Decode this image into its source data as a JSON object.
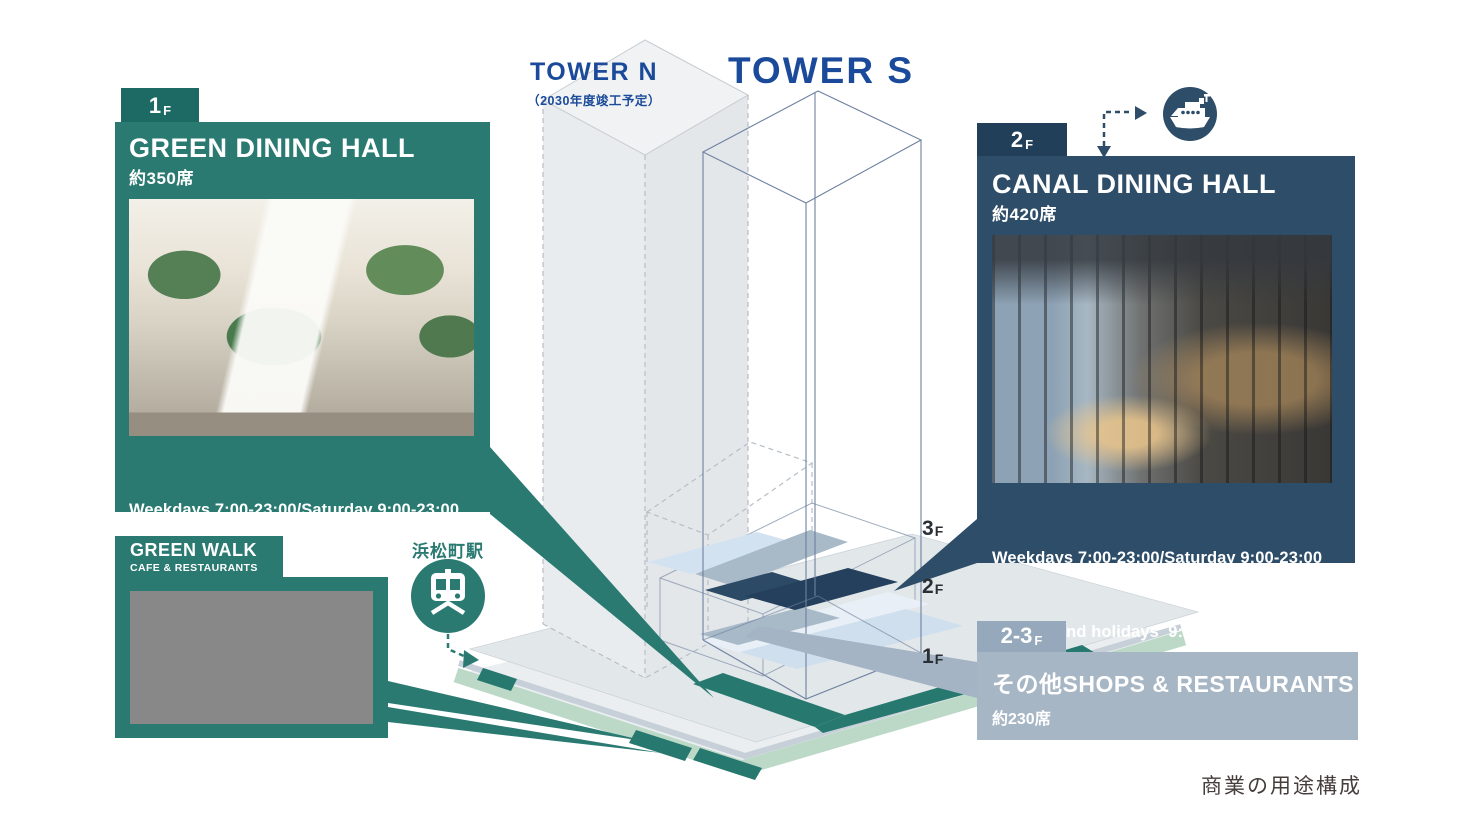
{
  "page": {
    "caption": "商業の用途構成"
  },
  "towers": {
    "tower_n": {
      "label": "TOWER N",
      "sub": "（2030年度竣工予定）"
    },
    "tower_s": {
      "label": "TOWER S"
    }
  },
  "floor_markers": [
    {
      "num": "3",
      "suf": "F"
    },
    {
      "num": "2",
      "suf": "F"
    },
    {
      "num": "1",
      "suf": "F"
    }
  ],
  "panels": {
    "green_dining": {
      "floor_num": "1",
      "floor_suf": "F",
      "title": "GREEN DINING HALL",
      "seats": "約350席",
      "hours1": "Weekdays 7:00-23:00/Saturday 9:00-23:00",
      "hours2": "Sunday and holidays  9:00-22:00"
    },
    "green_walk": {
      "title": "GREEN WALK",
      "subtitle": "CAFE & RESTAURANTS"
    },
    "canal_dining": {
      "floor_num": "2",
      "floor_suf": "F",
      "title": "CANAL DINING HALL",
      "seats": "約420席",
      "hours1": "Weekdays 7:00-23:00/Saturday 9:00-23:00",
      "hours2": "Sunday and holidays  9:00-22:00"
    },
    "shops": {
      "floor_num": "2-3",
      "floor_suf": "F",
      "title": "その他SHOPS & RESTAURANTS",
      "seats": "約230席"
    }
  },
  "station": {
    "label": "浜松町駅",
    "icon": "train-front-icon"
  },
  "pier": {
    "icon": "ferry-ship-icon"
  },
  "colors": {
    "teal": "#2a7a72",
    "teal_dark": "#1d6a64",
    "navy": "#2e4d68",
    "navy_dark": "#223f5a",
    "gray_blue": "#a7b6c5",
    "gray_blue_dark": "#96a9bc",
    "tower_text_blue": "#1b4a9b",
    "slab_navy": "#24405c",
    "slab_gray_blue": "#a8b9c8",
    "slab_pale_blue": "#cfdfee",
    "ground_green": "#bcd9c7",
    "ground_gray": "#e2e7ea"
  }
}
